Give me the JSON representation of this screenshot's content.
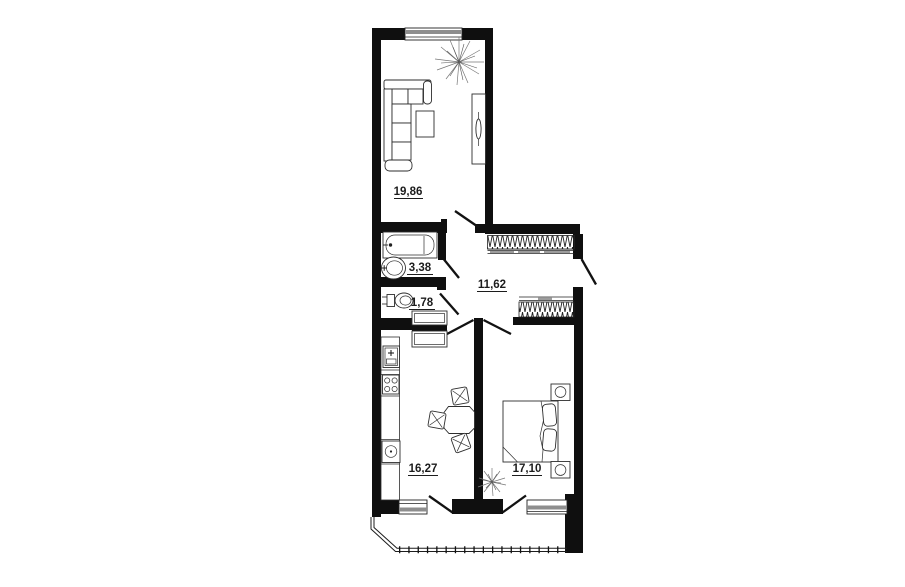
{
  "title": "Two-room apartment floor plan",
  "palette": {
    "wall": "#0f0f0f",
    "furniture_line": "#2e2e2e",
    "window_glass": "#8e8e8e",
    "wardrobe_hatch": "#222222",
    "label_text": "#1c1c1c",
    "background": "#ffffff"
  },
  "units": "m2",
  "rooms": [
    {
      "id": "living-room",
      "area": "19,86"
    },
    {
      "id": "bathroom",
      "area": "3,38"
    },
    {
      "id": "wc",
      "area": "1,78"
    },
    {
      "id": "hallway",
      "area": "11,62"
    },
    {
      "id": "kitchen",
      "area": "16,27"
    },
    {
      "id": "bedroom",
      "area": "17,10"
    }
  ]
}
